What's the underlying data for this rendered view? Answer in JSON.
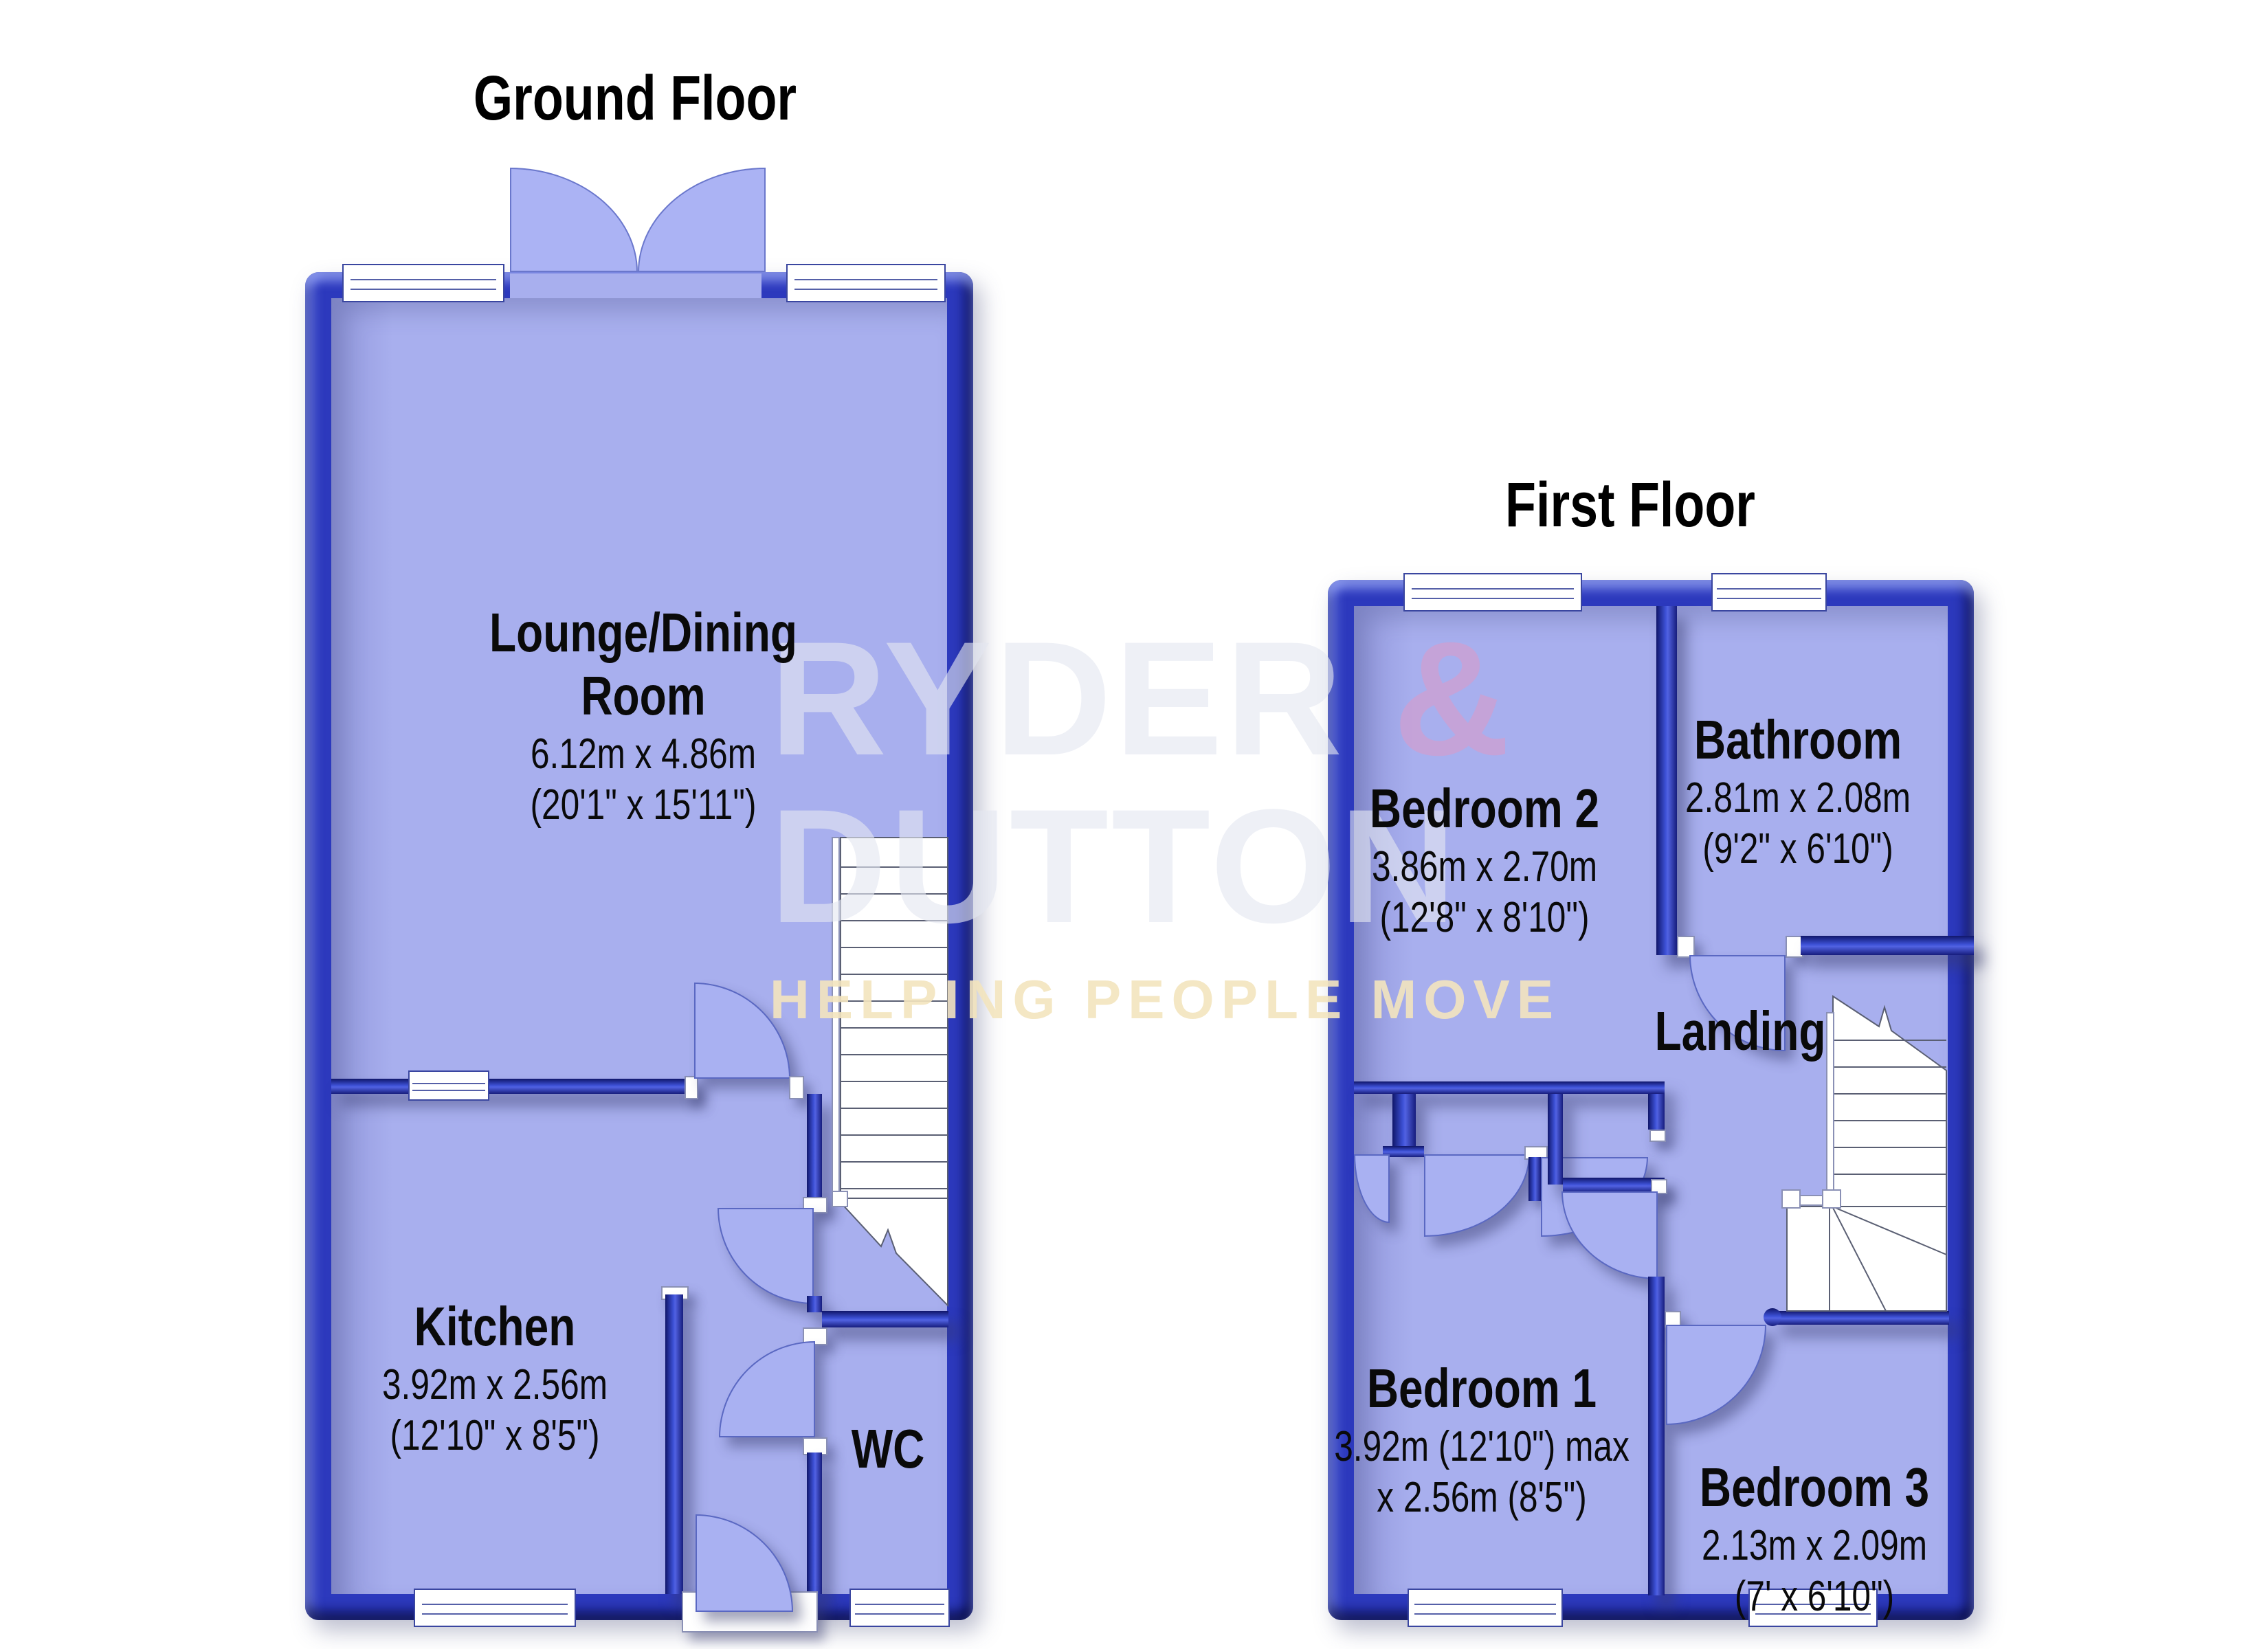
{
  "colors": {
    "wall_blue": "#2c39bd",
    "floor_fill": "#a8afee",
    "watermark_pink": "#d09ed0",
    "watermark_cream": "#f3e4be"
  },
  "watermark": {
    "brand_top": "RYDER ",
    "brand_amp": "&",
    "brand_bottom": "DUTTON",
    "tagline": "HELPING PEOPLE MOVE"
  },
  "ground_floor": {
    "title": "Ground Floor",
    "lounge": {
      "name_line1": "Lounge/Dining",
      "name_line2": "Room",
      "dims_metric": "6.12m x 4.86m",
      "dims_imperial": "(20'1\" x 15'11\")"
    },
    "kitchen": {
      "name": "Kitchen",
      "dims_metric": "3.92m x 2.56m",
      "dims_imperial": "(12'10\" x 8'5\")"
    },
    "wc": {
      "name": "WC"
    }
  },
  "first_floor": {
    "title": "First Floor",
    "bedroom2": {
      "name": "Bedroom 2",
      "dims_metric": "3.86m x 2.70m",
      "dims_imperial": "(12'8\" x 8'10\")"
    },
    "bathroom": {
      "name": "Bathroom",
      "dims_metric": "2.81m x 2.08m",
      "dims_imperial": "(9'2\" x 6'10\")"
    },
    "landing": {
      "name": "Landing"
    },
    "bedroom1": {
      "name": "Bedroom 1",
      "dims_line1": "3.92m (12'10\") max",
      "dims_line2": "x 2.56m (8'5\")"
    },
    "bedroom3": {
      "name": "Bedroom 3",
      "dims_metric": "2.13m x 2.09m",
      "dims_imperial": "(7' x 6'10\")"
    }
  }
}
